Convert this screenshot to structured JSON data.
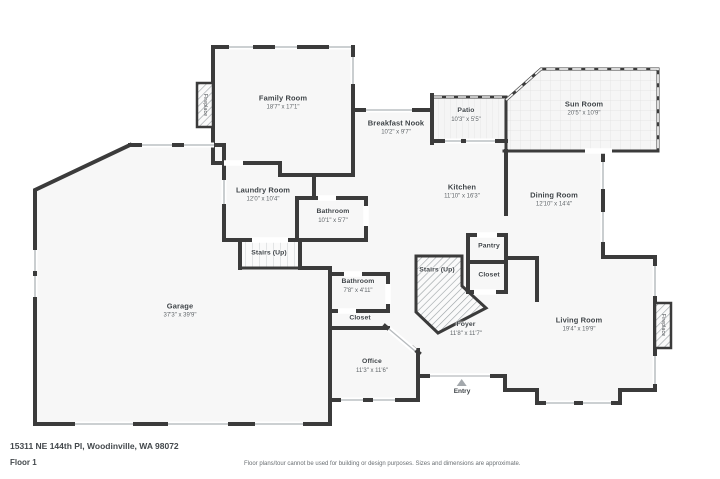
{
  "colors": {
    "wall": "#3b3b3b",
    "room_fill": "#f7f7f7",
    "text": "#3e4347"
  },
  "rooms": {
    "family_room": {
      "name": "Family Room",
      "dims": "18'7\" x 17'1\""
    },
    "breakfast_nook": {
      "name": "Breakfast Nook",
      "dims": "10'2\" x 9'7\""
    },
    "patio": {
      "name": "Patio",
      "dims": "10'3\" x 5'5\""
    },
    "sun_room": {
      "name": "Sun Room",
      "dims": "20'5\" x 10'9\""
    },
    "kitchen": {
      "name": "Kitchen",
      "dims": "11'10\" x 16'3\""
    },
    "dining_room": {
      "name": "Dining Room",
      "dims": "12'10\" x 14'4\""
    },
    "laundry_room": {
      "name": "Laundry Room",
      "dims": "12'0\" x 10'4\""
    },
    "bathroom_upper": {
      "name": "Bathroom",
      "dims": "10'1\" x 5'7\""
    },
    "stairs_upper": {
      "name": "Stairs (Up)"
    },
    "stairs_main": {
      "name": "Stairs (Up)"
    },
    "pantry": {
      "name": "Pantry"
    },
    "closet_hall": {
      "name": "Closet"
    },
    "foyer": {
      "name": "Foyer",
      "dims": "11'8\" x 11'7\""
    },
    "living_room": {
      "name": "Living Room",
      "dims": "19'4\" x 19'9\""
    },
    "garage": {
      "name": "Garage",
      "dims": "37'3\" x 39'9\""
    },
    "bathroom_main": {
      "name": "Bathroom",
      "dims": "7'8\" x 4'11\""
    },
    "closet_office": {
      "name": "Closet"
    },
    "office": {
      "name": "Office",
      "dims": "11'3\" x 11'6\""
    }
  },
  "fixtures": {
    "fireplace_family": {
      "label": "Fireplace"
    },
    "fireplace_living": {
      "label": "Fireplace"
    },
    "entry": {
      "label": "Entry"
    }
  },
  "footer": {
    "address": "15311 NE 144th Pl, Woodinville, WA 98072",
    "floor": "Floor 1",
    "disclaimer": "Floor plans/tour cannot be used for building or design purposes. Sizes and dimensions are approximate."
  }
}
